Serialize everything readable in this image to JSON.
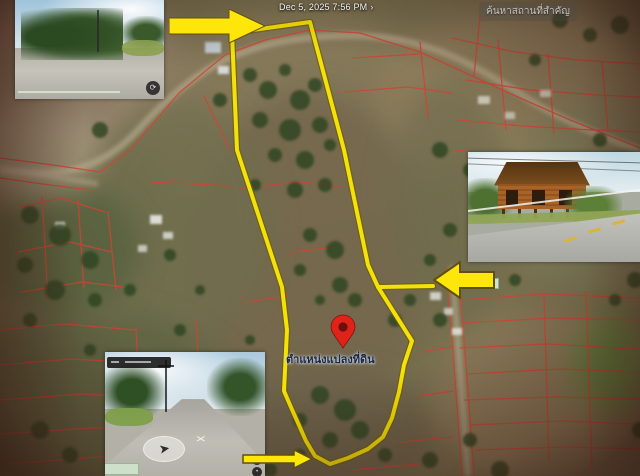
{
  "header": {
    "timestamp": "Dec 5, 2025 7:56 PM",
    "chevron": "›",
    "search_label": "ค้นหาสถานที่สำคัญ"
  },
  "map": {
    "pin_label": "ตำแหน่งแปลงที่ดิน",
    "pin": {
      "x": 343,
      "y": 348
    },
    "plot_outline_points": "232,33 310,22 344,150 368,265 378,287 412,341 404,365 399,392 392,418 383,437 368,449 348,458 330,464 315,456 306,441 290,405 284,391 287,330 282,287 237,150",
    "plot_branch_points": "378,287 433,286",
    "colors": {
      "plot_outline": "#f4e10c",
      "plot_outline_edge": "#6e5f07",
      "parcel_line": "#d04436",
      "pin_fill": "#e02318",
      "pin_core": "#6d0f0a",
      "arrow_fill": "#ffe60a",
      "arrow_edge": "#5f4f10"
    }
  },
  "annotations": {
    "arrow_top_direction": "right",
    "arrow_right_direction": "left",
    "arrow_bottom_direction": "right"
  }
}
